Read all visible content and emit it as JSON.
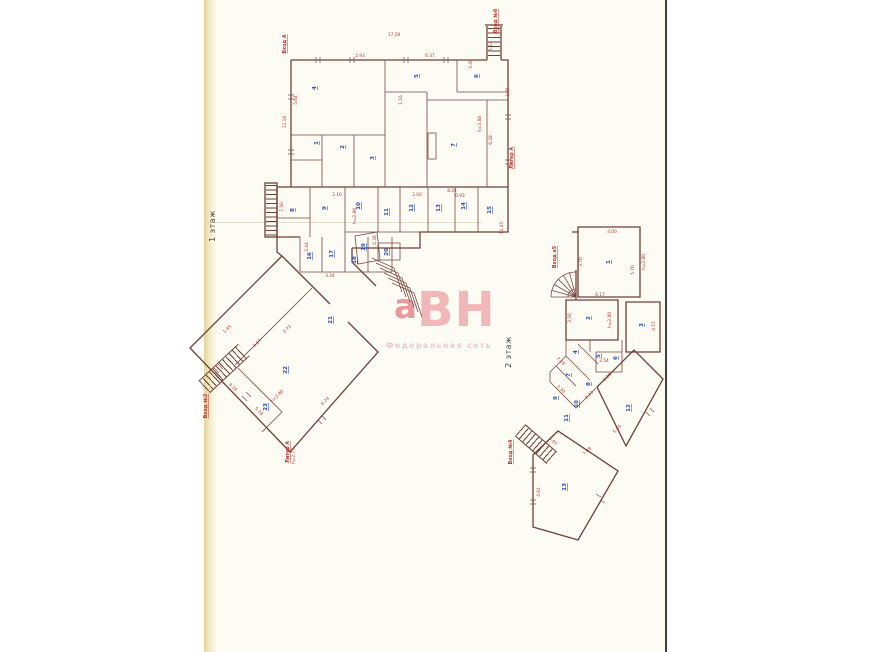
{
  "page": {
    "floor1": "1 этаж",
    "floor2": "2 этаж"
  },
  "watermark": {
    "lead": "а",
    "letters": "ВН",
    "subtitle": "Федеральная сеть"
  },
  "colors": {
    "wall": "#6f4038",
    "dimension": "#b5382f",
    "stamp": "#2f4fc0",
    "watermark": "#f2b0b3",
    "page_background": "#fcfbf4"
  },
  "floorplan": {
    "entrances": [
      {
        "x": 286,
        "y": 44,
        "r": -90,
        "t": "Вход А"
      },
      {
        "x": 497,
        "y": 21,
        "r": -90,
        "t": "Вход №6"
      },
      {
        "x": 513,
        "y": 158,
        "r": -90,
        "t": "Литер А"
      },
      {
        "x": 207,
        "y": 406,
        "r": -90,
        "t": "Вход №2"
      },
      {
        "x": 289,
        "y": 452,
        "r": -90,
        "t": "Литер А"
      },
      {
        "x": 556,
        "y": 257,
        "r": -90,
        "t": "Вход а5"
      },
      {
        "x": 512,
        "y": 452,
        "r": -90,
        "t": "Вход №4"
      }
    ],
    "dims": [
      {
        "x": 394,
        "y": 36,
        "r": 0,
        "t": "17.28"
      },
      {
        "x": 492,
        "y": 46,
        "r": -90,
        "t": "1.14"
      },
      {
        "x": 286,
        "y": 122,
        "r": -90,
        "t": "11.16"
      },
      {
        "x": 297,
        "y": 100,
        "r": -90,
        "t": "5.64"
      },
      {
        "x": 360,
        "y": 57,
        "r": 0,
        "t": "2.93"
      },
      {
        "x": 430,
        "y": 57,
        "r": 0,
        "t": "6.37"
      },
      {
        "x": 472,
        "y": 64,
        "r": -90,
        "t": "3.40"
      },
      {
        "x": 402,
        "y": 100,
        "r": -90,
        "t": "1.16"
      },
      {
        "x": 452,
        "y": 192,
        "r": 0,
        "t": "8.24"
      },
      {
        "x": 492,
        "y": 140,
        "r": -90,
        "t": "6.38"
      },
      {
        "x": 481,
        "y": 124,
        "r": -90,
        "t": "h=3.88"
      },
      {
        "x": 509,
        "y": 92,
        "r": -90,
        "t": "3.85"
      },
      {
        "x": 503,
        "y": 228,
        "r": -90,
        "t": "11.45"
      },
      {
        "x": 283,
        "y": 207,
        "r": -90,
        "t": "7.50"
      },
      {
        "x": 356,
        "y": 216,
        "r": -90,
        "t": "h=2.80"
      },
      {
        "x": 337,
        "y": 196,
        "r": 0,
        "t": "2.10"
      },
      {
        "x": 417,
        "y": 196,
        "r": 0,
        "t": "2.02"
      },
      {
        "x": 460,
        "y": 197,
        "r": 0,
        "t": "0.93"
      },
      {
        "x": 376,
        "y": 240,
        "r": -90,
        "t": "2.36"
      },
      {
        "x": 308,
        "y": 247,
        "r": -90,
        "t": "3.44"
      },
      {
        "x": 330,
        "y": 277,
        "r": 0,
        "t": "3.34"
      },
      {
        "x": 228,
        "y": 330,
        "r": -45,
        "t": "1.45"
      },
      {
        "x": 258,
        "y": 344,
        "r": -45,
        "t": "4.67"
      },
      {
        "x": 288,
        "y": 330,
        "r": -45,
        "t": "2.72"
      },
      {
        "x": 232,
        "y": 388,
        "r": 45,
        "t": "4.10"
      },
      {
        "x": 258,
        "y": 412,
        "r": 45,
        "t": "5.28"
      },
      {
        "x": 326,
        "y": 402,
        "r": -45,
        "t": "6.24"
      },
      {
        "x": 278,
        "y": 397,
        "r": -45,
        "t": "h=2.80"
      },
      {
        "x": 295,
        "y": 456,
        "r": -90,
        "t": "h=2.77"
      },
      {
        "x": 612,
        "y": 233,
        "r": 0,
        "t": "4.00"
      },
      {
        "x": 645,
        "y": 262,
        "r": -90,
        "t": "h=2.80"
      },
      {
        "x": 634,
        "y": 270,
        "r": -90,
        "t": "5.70"
      },
      {
        "x": 582,
        "y": 262,
        "r": -90,
        "t": "3.70"
      },
      {
        "x": 571,
        "y": 318,
        "r": -90,
        "t": "3.50"
      },
      {
        "x": 611,
        "y": 320,
        "r": -90,
        "t": "h=2.80"
      },
      {
        "x": 600,
        "y": 296,
        "r": 0,
        "t": "6.17"
      },
      {
        "x": 655,
        "y": 326,
        "r": -90,
        "t": "4.15"
      },
      {
        "x": 560,
        "y": 362,
        "r": 45,
        "t": "2.10"
      },
      {
        "x": 608,
        "y": 378,
        "r": -45,
        "t": "6.20"
      },
      {
        "x": 618,
        "y": 430,
        "r": -45,
        "t": "5.89"
      },
      {
        "x": 588,
        "y": 452,
        "r": -45,
        "t": "7.09"
      },
      {
        "x": 540,
        "y": 492,
        "r": -90,
        "t": "4.91"
      },
      {
        "x": 552,
        "y": 442,
        "r": 45,
        "t": "6.07"
      },
      {
        "x": 604,
        "y": 362,
        "r": 0,
        "t": "2.54"
      },
      {
        "x": 560,
        "y": 390,
        "r": 45,
        "t": "1.30"
      },
      {
        "x": 590,
        "y": 396,
        "r": -45,
        "t": "2.33"
      }
    ],
    "stamps": [
      {
        "x": 318,
        "y": 143,
        "r": -90,
        "t": "1"
      },
      {
        "x": 344,
        "y": 147,
        "r": -90,
        "t": "2"
      },
      {
        "x": 374,
        "y": 158,
        "r": -90,
        "t": "3"
      },
      {
        "x": 316,
        "y": 88,
        "r": -90,
        "t": "4"
      },
      {
        "x": 418,
        "y": 76,
        "r": -90,
        "t": "5"
      },
      {
        "x": 478,
        "y": 76,
        "r": -90,
        "t": "6"
      },
      {
        "x": 455,
        "y": 145,
        "r": -90,
        "t": "7"
      },
      {
        "x": 294,
        "y": 210,
        "r": -90,
        "t": "8"
      },
      {
        "x": 326,
        "y": 208,
        "r": -90,
        "t": "9"
      },
      {
        "x": 360,
        "y": 206,
        "r": -90,
        "t": "10"
      },
      {
        "x": 388,
        "y": 212,
        "r": -90,
        "t": "11"
      },
      {
        "x": 413,
        "y": 208,
        "r": -90,
        "t": "12"
      },
      {
        "x": 440,
        "y": 208,
        "r": -90,
        "t": "13"
      },
      {
        "x": 465,
        "y": 206,
        "r": -90,
        "t": "14"
      },
      {
        "x": 491,
        "y": 210,
        "r": -90,
        "t": "15"
      },
      {
        "x": 311,
        "y": 256,
        "r": -90,
        "t": "16"
      },
      {
        "x": 333,
        "y": 254,
        "r": -90,
        "t": "17"
      },
      {
        "x": 356,
        "y": 260,
        "r": -90,
        "t": "18"
      },
      {
        "x": 365,
        "y": 247,
        "r": -90,
        "t": "19"
      },
      {
        "x": 388,
        "y": 252,
        "r": -90,
        "t": "20"
      },
      {
        "x": 332,
        "y": 320,
        "r": -90,
        "t": "21"
      },
      {
        "x": 287,
        "y": 370,
        "r": -90,
        "t": "22"
      },
      {
        "x": 267,
        "y": 407,
        "r": -90,
        "t": "23"
      },
      {
        "x": 610,
        "y": 262,
        "r": -90,
        "t": "1"
      },
      {
        "x": 590,
        "y": 318,
        "r": -90,
        "t": "2"
      },
      {
        "x": 643,
        "y": 325,
        "r": -90,
        "t": "3"
      },
      {
        "x": 577,
        "y": 352,
        "r": -90,
        "t": "4"
      },
      {
        "x": 600,
        "y": 356,
        "r": -90,
        "t": "5"
      },
      {
        "x": 617,
        "y": 358,
        "r": -90,
        "t": "6"
      },
      {
        "x": 570,
        "y": 375,
        "r": -90,
        "t": "7"
      },
      {
        "x": 590,
        "y": 384,
        "r": -90,
        "t": "8"
      },
      {
        "x": 557,
        "y": 398,
        "r": -90,
        "t": "9"
      },
      {
        "x": 578,
        "y": 404,
        "r": -90,
        "t": "10"
      },
      {
        "x": 568,
        "y": 418,
        "r": -90,
        "t": "11"
      },
      {
        "x": 630,
        "y": 408,
        "r": -90,
        "t": "12"
      },
      {
        "x": 566,
        "y": 487,
        "r": -90,
        "t": "13"
      }
    ]
  }
}
